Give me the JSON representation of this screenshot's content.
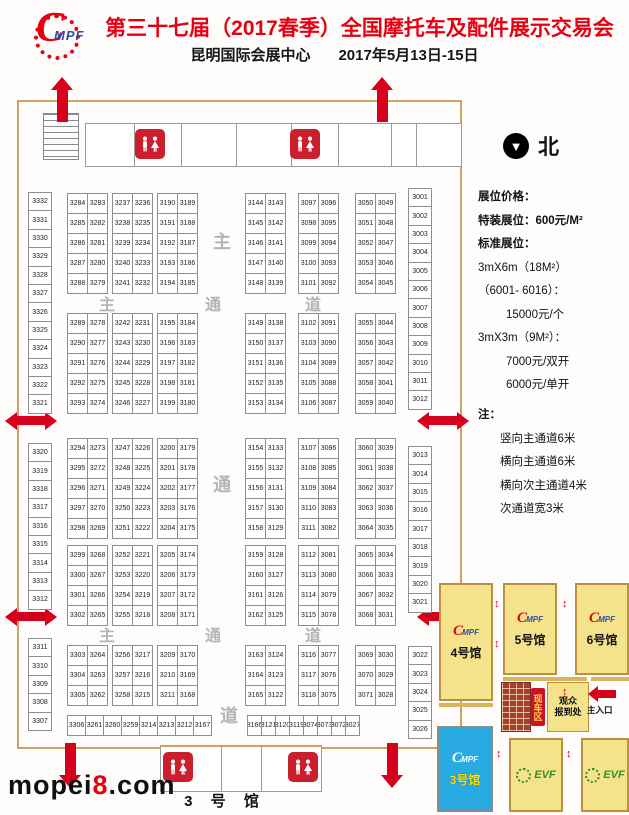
{
  "header": {
    "logo_c": "C",
    "logo_mpf": "MPF",
    "title": "第三十七届（2017春季）全国摩托车及配件展示交易会",
    "subtitle_venue": "昆明国际会展中心",
    "subtitle_date": "2017年5月13日-15日"
  },
  "floorplan": {
    "hall_label": "3 号 馆",
    "aisle_chars": [
      "主",
      "通",
      "道"
    ],
    "left_column": [
      [
        "3332",
        "3331",
        "3330",
        "3329",
        "3328",
        "3327",
        "3326",
        "3325",
        "3324",
        "3323",
        "3322",
        "3321"
      ],
      [
        "3320",
        "3319",
        "3318",
        "3317",
        "3316",
        "3315",
        "3314",
        "3313",
        "3312"
      ],
      [
        "3311",
        "3310",
        "3309",
        "3308",
        "3307"
      ]
    ],
    "right_column": [
      [
        "3001",
        "3002",
        "3003",
        "3004",
        "3005",
        "3006",
        "3007",
        "3008",
        "3009",
        "3010",
        "3011",
        "3012"
      ],
      [
        "3013",
        "3014",
        "3015",
        "3016",
        "3017",
        "3018",
        "3019",
        "3020",
        "3021"
      ],
      [
        "3022",
        "3023",
        "3024",
        "3025",
        "3026"
      ]
    ],
    "bands": [
      [
        [
          [
            "3284",
            "3283"
          ],
          [
            "3285",
            "3282"
          ],
          [
            "3286",
            "3281"
          ],
          [
            "3287",
            "3280"
          ],
          [
            "3288",
            "3279"
          ]
        ],
        [
          [
            "3237",
            "3236"
          ],
          [
            "3238",
            "3235"
          ],
          [
            "3239",
            "3234"
          ],
          [
            "3240",
            "3233"
          ],
          [
            "3241",
            "3232"
          ]
        ],
        [
          [
            "3190",
            "3189"
          ],
          [
            "3191",
            "3188"
          ],
          [
            "3192",
            "3187"
          ],
          [
            "3193",
            "3186"
          ],
          [
            "3194",
            "3185"
          ]
        ],
        [
          [
            "3144",
            "3143"
          ],
          [
            "3145",
            "3142"
          ],
          [
            "3146",
            "3141"
          ],
          [
            "3147",
            "3140"
          ],
          [
            "3148",
            "3139"
          ]
        ],
        [
          [
            "3097",
            "3096"
          ],
          [
            "3098",
            "3095"
          ],
          [
            "3099",
            "3094"
          ],
          [
            "3100",
            "3093"
          ],
          [
            "3101",
            "3092"
          ]
        ],
        [
          [
            "3050",
            "3049"
          ],
          [
            "3051",
            "3048"
          ],
          [
            "3052",
            "3047"
          ],
          [
            "3053",
            "3046"
          ],
          [
            "3054",
            "3045"
          ]
        ]
      ],
      [
        [
          [
            "3289",
            "3278"
          ],
          [
            "3290",
            "3277"
          ],
          [
            "3291",
            "3276"
          ],
          [
            "3292",
            "3275"
          ],
          [
            "3293",
            "3274"
          ]
        ],
        [
          [
            "3242",
            "3231"
          ],
          [
            "3243",
            "3230"
          ],
          [
            "3244",
            "3229"
          ],
          [
            "3245",
            "3228"
          ],
          [
            "3246",
            "3227"
          ]
        ],
        [
          [
            "3195",
            "3184"
          ],
          [
            "3196",
            "3183"
          ],
          [
            "3197",
            "3182"
          ],
          [
            "3198",
            "3181"
          ],
          [
            "3199",
            "3180"
          ]
        ],
        [
          [
            "3149",
            "3138"
          ],
          [
            "3150",
            "3137"
          ],
          [
            "3151",
            "3136"
          ],
          [
            "3152",
            "3135"
          ],
          [
            "3153",
            "3134"
          ]
        ],
        [
          [
            "3102",
            "3091"
          ],
          [
            "3103",
            "3090"
          ],
          [
            "3104",
            "3089"
          ],
          [
            "3105",
            "3088"
          ],
          [
            "3106",
            "3087"
          ]
        ],
        [
          [
            "3055",
            "3044"
          ],
          [
            "3056",
            "3043"
          ],
          [
            "3057",
            "3042"
          ],
          [
            "3058",
            "3041"
          ],
          [
            "3059",
            "3040"
          ]
        ]
      ],
      [
        [
          [
            "3294",
            "3273"
          ],
          [
            "3295",
            "3272"
          ],
          [
            "3296",
            "3271"
          ],
          [
            "3297",
            "3270"
          ],
          [
            "3298",
            "3269"
          ]
        ],
        [
          [
            "3247",
            "3226"
          ],
          [
            "3248",
            "3225"
          ],
          [
            "3249",
            "3224"
          ],
          [
            "3250",
            "3223"
          ],
          [
            "3251",
            "3222"
          ]
        ],
        [
          [
            "3200",
            "3179"
          ],
          [
            "3201",
            "3178"
          ],
          [
            "3202",
            "3177"
          ],
          [
            "3203",
            "3176"
          ],
          [
            "3204",
            "3175"
          ]
        ],
        [
          [
            "3154",
            "3133"
          ],
          [
            "3155",
            "3132"
          ],
          [
            "3156",
            "3131"
          ],
          [
            "3157",
            "3130"
          ],
          [
            "3158",
            "3129"
          ]
        ],
        [
          [
            "3107",
            "3086"
          ],
          [
            "3108",
            "3085"
          ],
          [
            "3109",
            "3084"
          ],
          [
            "3110",
            "3083"
          ],
          [
            "3111",
            "3082"
          ]
        ],
        [
          [
            "3060",
            "3039"
          ],
          [
            "3061",
            "3038"
          ],
          [
            "3062",
            "3037"
          ],
          [
            "3063",
            "3036"
          ],
          [
            "3064",
            "3035"
          ]
        ]
      ],
      [
        [
          [
            "3299",
            "3268"
          ],
          [
            "3300",
            "3267"
          ],
          [
            "3301",
            "3266"
          ],
          [
            "3302",
            "3265"
          ]
        ],
        [
          [
            "3252",
            "3221"
          ],
          [
            "3253",
            "3220"
          ],
          [
            "3254",
            "3219"
          ],
          [
            "3255",
            "3218"
          ]
        ],
        [
          [
            "3205",
            "3174"
          ],
          [
            "3206",
            "3173"
          ],
          [
            "3207",
            "3172"
          ],
          [
            "3208",
            "3171"
          ]
        ],
        [
          [
            "3159",
            "3128"
          ],
          [
            "3160",
            "3127"
          ],
          [
            "3161",
            "3126"
          ],
          [
            "3162",
            "3125"
          ]
        ],
        [
          [
            "3112",
            "3081"
          ],
          [
            "3113",
            "3080"
          ],
          [
            "3114",
            "3079"
          ],
          [
            "3115",
            "3078"
          ]
        ],
        [
          [
            "3065",
            "3034"
          ],
          [
            "3066",
            "3033"
          ],
          [
            "3067",
            "3032"
          ],
          [
            "3068",
            "3031"
          ]
        ]
      ],
      [
        [
          [
            "3303",
            "3264"
          ],
          [
            "3304",
            "3263"
          ],
          [
            "3305",
            "3262"
          ]
        ],
        [
          [
            "3256",
            "3217"
          ],
          [
            "3257",
            "3216"
          ],
          [
            "3258",
            "3215"
          ]
        ],
        [
          [
            "3209",
            "3170"
          ],
          [
            "3210",
            "3169"
          ],
          [
            "3211",
            "3168"
          ]
        ],
        [
          [
            "3163",
            "3124"
          ],
          [
            "3164",
            "3123"
          ],
          [
            "3165",
            "3122"
          ]
        ],
        [
          [
            "3116",
            "3077"
          ],
          [
            "3117",
            "3076"
          ],
          [
            "3118",
            "3075"
          ]
        ],
        [
          [
            "3069",
            "3030"
          ],
          [
            "3070",
            "3029"
          ],
          [
            "3071",
            "3028"
          ]
        ]
      ]
    ],
    "bottom_row_left": [
      "3306",
      "3261",
      "3260",
      "3259",
      "3214",
      "3213",
      "3212",
      "3167"
    ],
    "bottom_row_right": [
      "3166",
      "3121",
      "3120",
      "3119",
      "3074",
      "3073",
      "3072",
      "3027"
    ]
  },
  "legend": {
    "north_label": "北",
    "north_icon": "▼",
    "lines": [
      {
        "text": "展位价格：",
        "cls": "bold"
      },
      {
        "text": "特装展位：600元/M²",
        "cls": "bold"
      },
      {
        "text": "标准展位：",
        "cls": "bold"
      },
      {
        "text": "3mX6m（18M²）",
        "cls": ""
      },
      {
        "text": "（6001- 6016）：",
        "cls": ""
      },
      {
        "text": "15000元/个",
        "cls": "ind"
      },
      {
        "text": "3mX3m（9M²）：",
        "cls": ""
      },
      {
        "text": "7000元/双开",
        "cls": "ind"
      },
      {
        "text": "6000元/单开",
        "cls": "ind"
      },
      {
        "text": "注：",
        "cls": "note"
      },
      {
        "text": "竖向主通道6米",
        "cls": "ind2"
      },
      {
        "text": "横向主通道6米",
        "cls": "ind2"
      },
      {
        "text": "横向次主通道4米",
        "cls": "ind2"
      },
      {
        "text": "次通道宽3米",
        "cls": "ind2"
      }
    ]
  },
  "minimap": {
    "halls": [
      "4号馆",
      "5号馆",
      "6号馆"
    ],
    "hall3": "3号馆",
    "evf_label": "EVF",
    "logo_c": "C",
    "logo_mpf": "MPF",
    "registration_line1": "观众",
    "registration_line2": "报到处",
    "vertical_label": "现车区",
    "main_entrance": "主入口"
  },
  "watermark": {
    "prefix": "mopei",
    "eight": "8",
    "suffix": ".com"
  }
}
